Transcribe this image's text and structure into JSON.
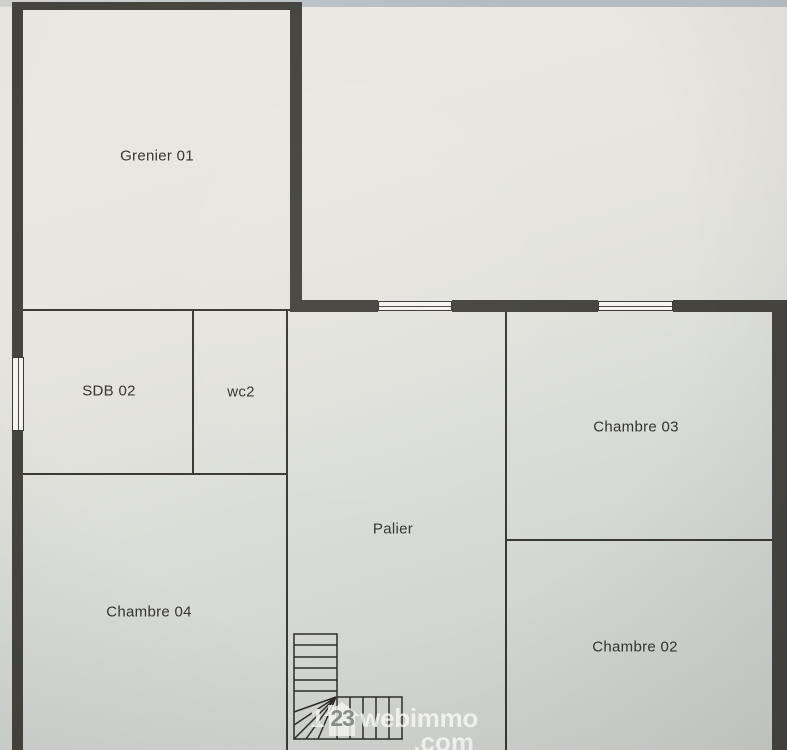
{
  "rooms": {
    "grenier01": {
      "label": "Grenier 01"
    },
    "sdb02": {
      "label": "SDB 02"
    },
    "wc2": {
      "label": "wc2"
    },
    "chambre03": {
      "label": "Chambre 03"
    },
    "palier": {
      "label": "Palier"
    },
    "chambre04": {
      "label": "Chambre 04"
    },
    "chambre02": {
      "label": "Chambre 02"
    }
  },
  "watermark": {
    "digit_one": "1",
    "digits_in_house": "23",
    "brand": "webimmo",
    "tld": ".com"
  },
  "colors": {
    "wall": "#45443e",
    "partition_line": "#3a3934",
    "paper_light": "#eae8e2",
    "paper_dark": "#cbcec9",
    "window_fill": "#f5f4f1",
    "photo_top_edge": "#b4bcc2",
    "label_text": "#35342f",
    "watermark_text": "#fbfbf9"
  }
}
